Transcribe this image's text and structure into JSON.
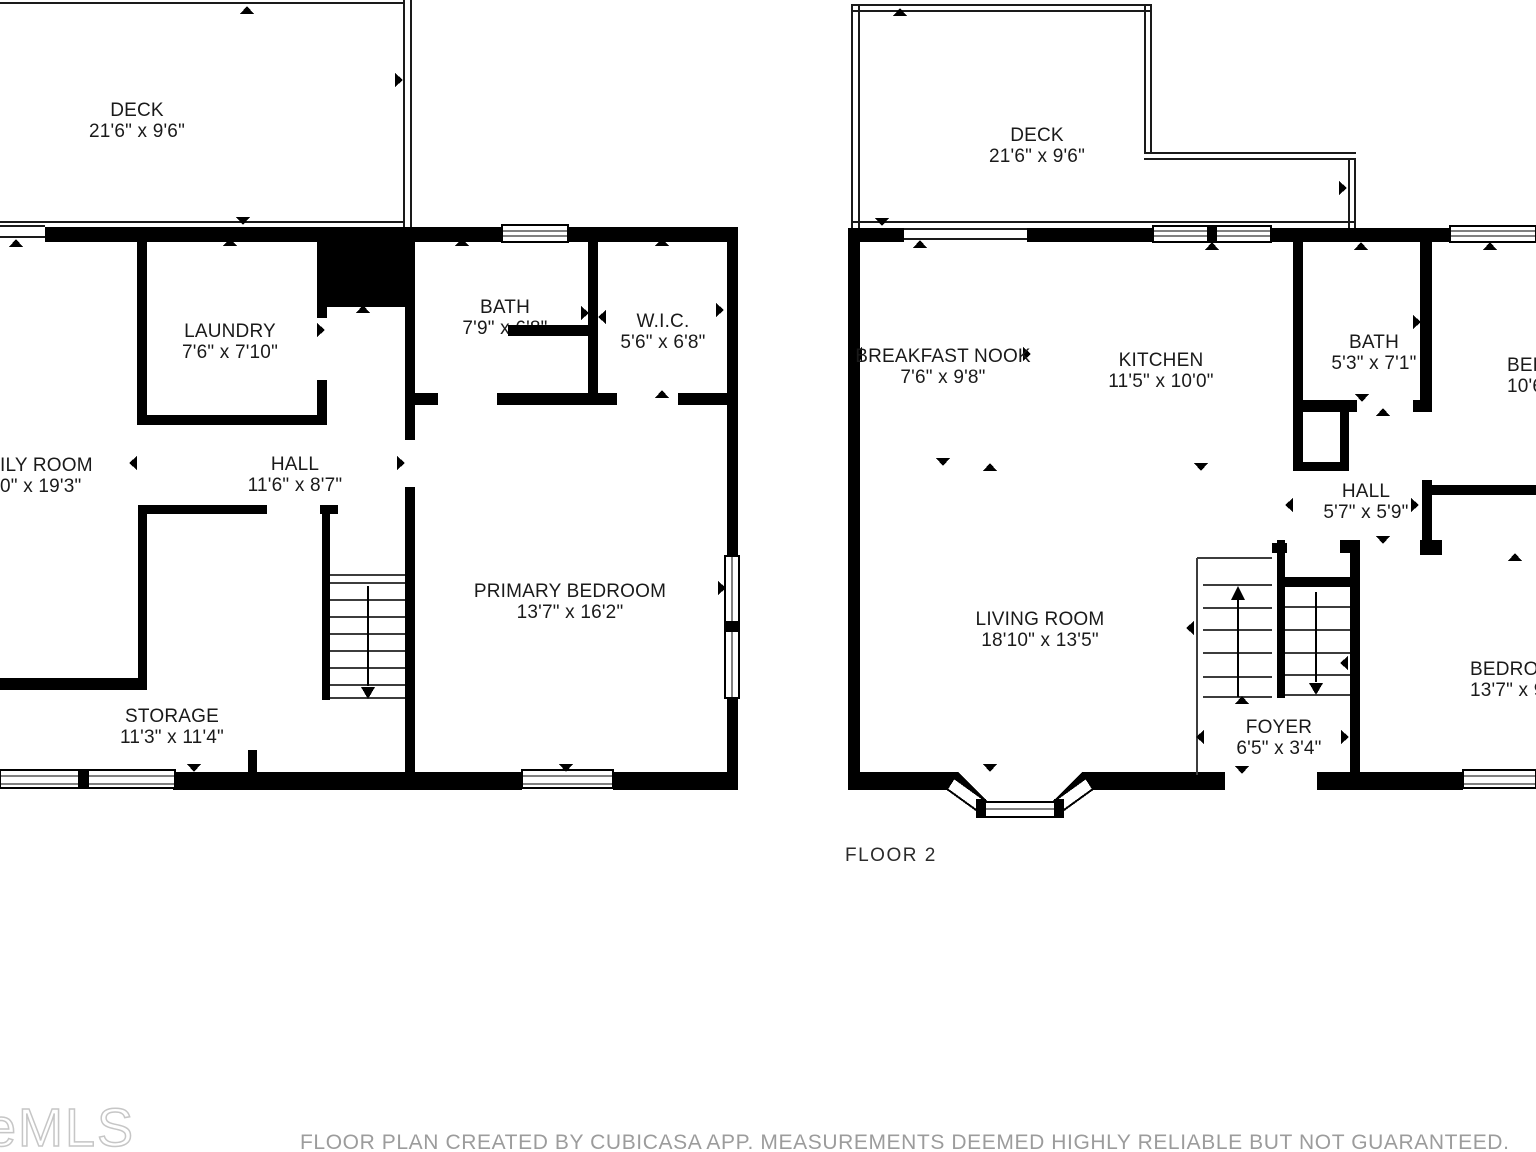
{
  "floor_label": "FLOOR 2",
  "watermark": "eMLS",
  "disclaimer": "FLOOR PLAN CREATED BY CUBICASA APP. MEASUREMENTS DEEMED HIGHLY RELIABLE BUT NOT GUARANTEED.",
  "colors": {
    "wall": "#000000",
    "text": "#1a1a1a",
    "muted_text": "#9c9c9c",
    "watermark_stroke": "#c6c6c6"
  },
  "icons": {
    "door-window-tick": "▲ small triangle marker",
    "stair-up-arrow": "↑",
    "stair-down-arrow": "↓"
  },
  "rooms": [
    {
      "id": "deck-floor1",
      "name": "DECK",
      "dims": "21'6\" x 9'6\""
    },
    {
      "id": "laundry",
      "name": "LAUNDRY",
      "dims": "7'6\" x 7'10\""
    },
    {
      "id": "bath-floor1",
      "name": "BATH",
      "dims": "7'9\" x 6'8\""
    },
    {
      "id": "wic",
      "name": "W.I.C.",
      "dims": "5'6\" x 6'8\""
    },
    {
      "id": "family-room-cut",
      "name": "ILY ROOM",
      "dims": "0\" x 19'3\""
    },
    {
      "id": "hall-floor1",
      "name": "HALL",
      "dims": "11'6\" x 8'7\""
    },
    {
      "id": "primary-bedroom",
      "name": "PRIMARY BEDROOM",
      "dims": "13'7\" x 16'2\""
    },
    {
      "id": "storage",
      "name": "STORAGE",
      "dims": "11'3\" x 11'4\""
    },
    {
      "id": "deck-floor2",
      "name": "DECK",
      "dims": "21'6\" x 9'6\""
    },
    {
      "id": "breakfast-nook",
      "name": "BREAKFAST NOOK",
      "dims": "7'6\" x 9'8\""
    },
    {
      "id": "kitchen",
      "name": "KITCHEN",
      "dims": "11'5\" x 10'0\""
    },
    {
      "id": "bath-floor2",
      "name": "BATH",
      "dims": "5'3\" x 7'1\""
    },
    {
      "id": "bed-upper-cut",
      "name": "BED",
      "dims": "10'6"
    },
    {
      "id": "hall-floor2",
      "name": "HALL",
      "dims": "5'7\" x 5'9\""
    },
    {
      "id": "living-room",
      "name": "LIVING ROOM",
      "dims": "18'10\" x 13'5\""
    },
    {
      "id": "foyer",
      "name": "FOYER",
      "dims": "6'5\" x 3'4\""
    },
    {
      "id": "bedroom-lower-cut",
      "name": "BEDROO",
      "dims": "13'7\" x 9"
    }
  ]
}
